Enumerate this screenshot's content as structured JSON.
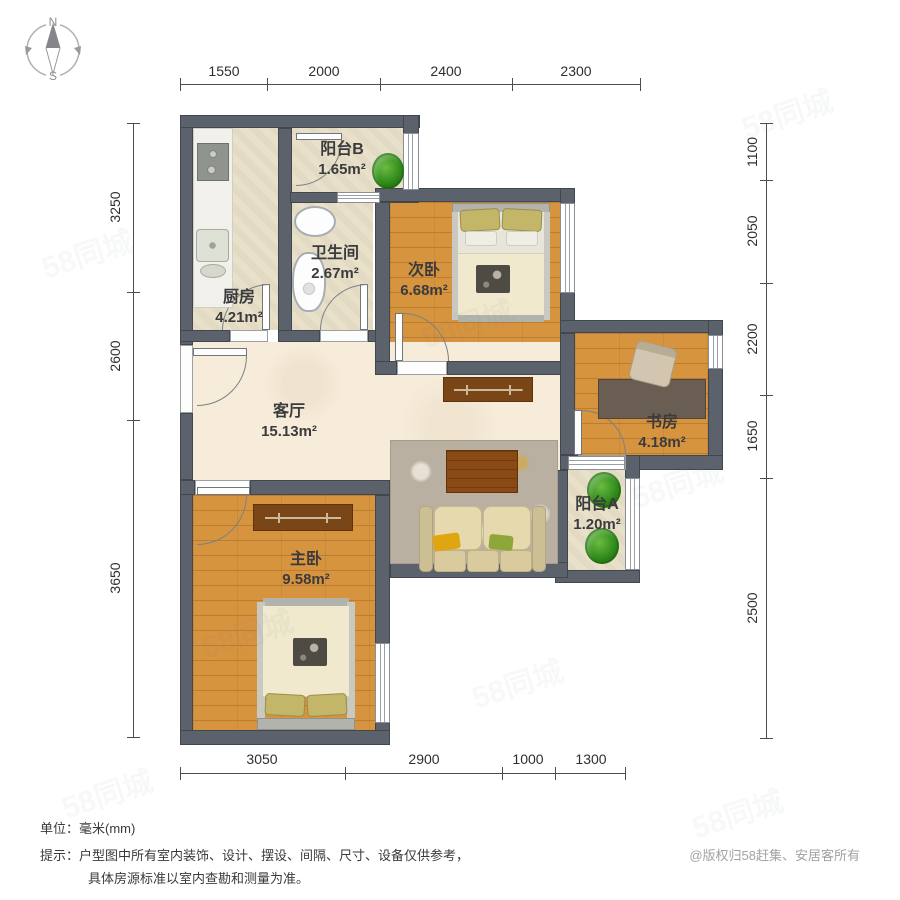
{
  "page": {
    "unit_prefix": "单位：",
    "unit_value": "毫米(mm)",
    "tip_prefix": "提示：",
    "tip_line1": "户型图中所有室内装饰、设计、摆设、间隔、尺寸、设备仅供参考，",
    "tip_line2": "具体房源标准以室内查勘和测量为准。",
    "copyright": "@版权归58赶集、安居客所有"
  },
  "compass": {
    "north": "N",
    "south": "S"
  },
  "watermark": {
    "text": "58同城"
  },
  "dimensions": {
    "top": [
      "1550",
      "2000",
      "2400",
      "2300"
    ],
    "bottom": [
      "3050",
      "2900",
      "1000",
      "1300"
    ],
    "left": [
      "3250",
      "2600",
      "3650"
    ],
    "right": [
      "1100",
      "2050",
      "2200",
      "1650",
      "2500"
    ]
  },
  "rooms": [
    {
      "name": "阳台B",
      "area": "1.65m²"
    },
    {
      "name": "卫生间",
      "area": "2.67m²"
    },
    {
      "name": "厨房",
      "area": "4.21m²"
    },
    {
      "name": "次卧",
      "area": "6.68m²"
    },
    {
      "name": "客厅",
      "area": "15.13m²"
    },
    {
      "name": "书房",
      "area": "4.18m²"
    },
    {
      "name": "阳台A",
      "area": "1.20m²"
    },
    {
      "name": "主卧",
      "area": "9.58m²"
    }
  ],
  "colors": {
    "wall": "#5c626b",
    "wood_floor": "#d6943f",
    "tile_floor": "#e8e0c9",
    "living_floor": "#f6ecd9",
    "cabinet_wood": "#7a4517",
    "plant_green": "#2f8a1a"
  }
}
